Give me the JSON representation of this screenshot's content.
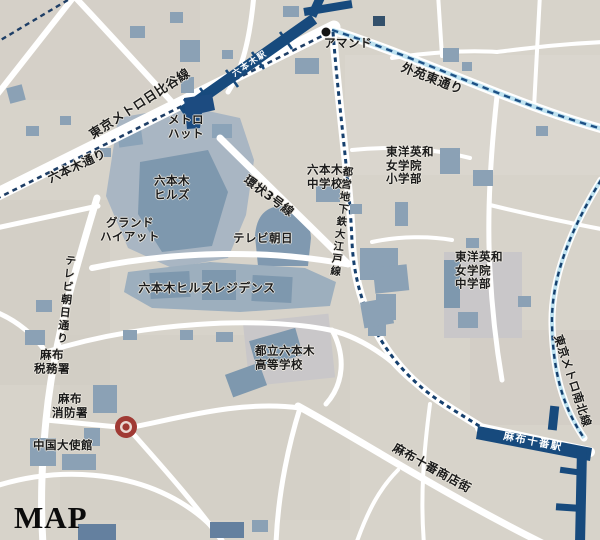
{
  "map": {
    "caption": "MAP",
    "labels": {
      "hibiya_line": "東京メトロ日比谷線",
      "roppongi_dori": "六本木通り",
      "metro_hat": "メトロ\nハット",
      "roppongi_hills": "六本木\nヒルズ",
      "grand_hyatt": "グランド\nハイアット",
      "tv_asahi": "テレビ朝日",
      "kanjo3": "環状3号線",
      "residence": "六本木ヒルズレジデンス",
      "tv_asahi_dori": "テレビ朝日通り",
      "roppongi_jhs": "六本木\n中学校",
      "toyo_eiwa_elem": "東洋英和\n女学院\n小学部",
      "gaien_higashi_dori": "外苑東通り",
      "almond": "アマンド",
      "oedo_line": "都営地下鉄大江戸線",
      "toyo_eiwa_jhs": "東洋英和\n女学院\n中学部",
      "toritsu_high": "都立六本木\n高等学校",
      "azabu_tax": "麻布\n税務署",
      "azabu_fire": "麻布\n消防署",
      "china_embassy": "中国大使館",
      "shotengai": "麻布十番商店街",
      "azabu_juban_station": "麻布十番駅",
      "namboku_line": "東京メトロ南北線",
      "roppongi_station": "六本木駅"
    },
    "colors": {
      "background": "#d7d3ca",
      "road": "#ffffff",
      "building": "#8ba1b5",
      "building_dark": "#7e98ae",
      "subway_navy": "#174a7d",
      "rail_dash": "#1e3e66",
      "rail_halo": "#bfe2f0",
      "marker_red": "#a03a34",
      "school_zone": "#c9c7c9"
    }
  }
}
